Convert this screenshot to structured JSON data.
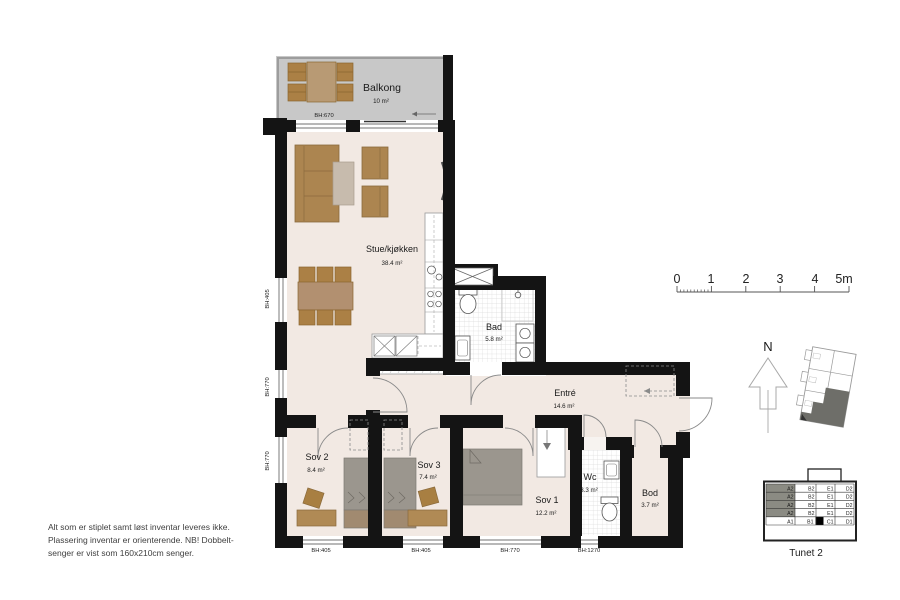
{
  "rooms": {
    "balkong": {
      "name": "Balkong",
      "area": "10 m²"
    },
    "stue": {
      "name": "Stue/kjøkken",
      "area": "38.4 m²"
    },
    "bad": {
      "name": "Bad",
      "area": "5.8 m²"
    },
    "entre": {
      "name": "Entré",
      "area": "14.6 m²"
    },
    "sov2": {
      "name": "Sov 2",
      "area": "8.4 m²"
    },
    "sov3": {
      "name": "Sov 3",
      "area": "7.4 m²"
    },
    "sov1": {
      "name": "Sov 1",
      "area": "12.2 m²"
    },
    "wc": {
      "name": "Wc",
      "area": "3.3 m²"
    },
    "bod": {
      "name": "Bod",
      "area": "3.7 m²"
    }
  },
  "windows": {
    "balcony": "BH:670",
    "left": [
      "BH:405",
      "BH:770",
      "BH:770"
    ],
    "bottom": [
      "BH:405",
      "BH:405",
      "BH:770",
      "BH:1270"
    ]
  },
  "scale": {
    "labels": [
      "0",
      "1",
      "2",
      "3",
      "4",
      "5m"
    ]
  },
  "compass": {
    "north": "N"
  },
  "building": {
    "title": "Tunet 2",
    "rows": [
      [
        "A2",
        "B2",
        "E1",
        "D2"
      ],
      [
        "A2",
        "B2",
        "E1",
        "D2"
      ],
      [
        "A2",
        "B2",
        "E1",
        "D2"
      ],
      [
        "A2",
        "B2",
        "E1",
        "D2"
      ],
      [
        "A1",
        "B1",
        "C1",
        "D1"
      ]
    ]
  },
  "notes": {
    "lines": [
      "Alt som er stiplet samt løst inventar leveres ikke.",
      "Plassering inventar er orienterende. NB! Dobbelt-",
      "senger er vist som 160x210cm senger."
    ]
  },
  "colors": {
    "floor": "#f2e9e3",
    "balcony_floor": "#c8c8c8",
    "wall": "#141414",
    "furniture_brown": "#ab8045",
    "bed_gray": "#9b968e",
    "map_dark": "#6e6e69"
  }
}
